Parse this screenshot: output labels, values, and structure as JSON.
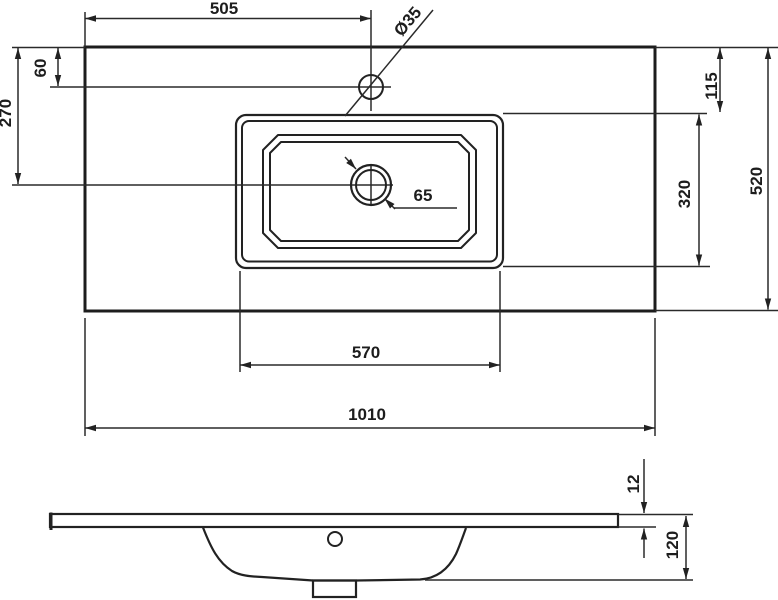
{
  "drawing": {
    "title": "washbasin-dimension-drawing",
    "top_view": {
      "dims": {
        "faucet_from_left": "505",
        "hole_diameter": "Ø35",
        "faucet_from_edge": "60",
        "drain_from_top": "270",
        "basin_from_top": "115",
        "basin_depth": "320",
        "counter_depth": "520",
        "drain_diameter": "65",
        "basin_width": "570",
        "counter_width": "1010"
      }
    },
    "side_view": {
      "dims": {
        "slab_thickness": "12",
        "total_height": "120"
      }
    },
    "colors": {
      "line": "#222222",
      "background": "#ffffff"
    }
  }
}
